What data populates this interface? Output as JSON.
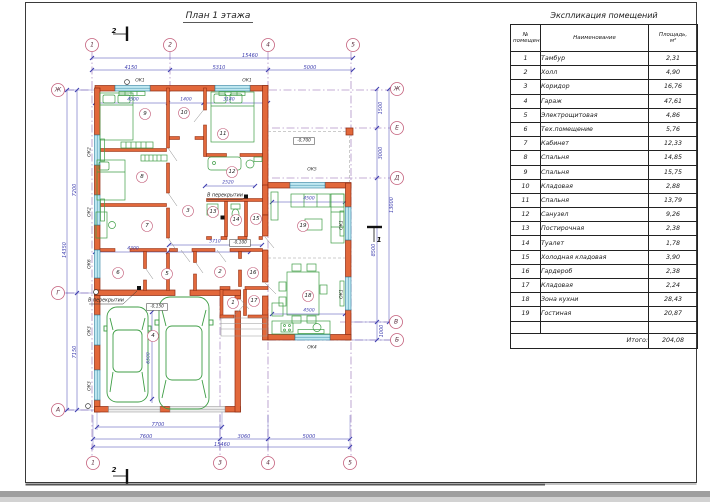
{
  "colors": {
    "wall_fill": "#e2683b",
    "wall_edge": "#8e2a10",
    "window_fill": "#bfe8f1",
    "window_edge": "#2e7f9e",
    "furniture": "#3f9e46",
    "dim": "#4040b0",
    "axis_line": "#8a5fae",
    "bubble": "#c4607c"
  },
  "plan": {
    "labels": [
      {
        "t": "План 1 этажа",
        "x": 218,
        "y": 16,
        "s": 9,
        "cls": "title",
        "n": "plan-title"
      },
      {
        "t": "1",
        "x": 92,
        "y": 45,
        "s": 6,
        "cls": "axis",
        "circle": true,
        "cr": 6.5,
        "n": "axis-top-1"
      },
      {
        "t": "2",
        "x": 170,
        "y": 45,
        "s": 6,
        "cls": "axis",
        "circle": true,
        "cr": 6.5,
        "n": "axis-top-2"
      },
      {
        "t": "4",
        "x": 268,
        "y": 45,
        "s": 6,
        "cls": "axis",
        "circle": true,
        "cr": 6.5,
        "n": "axis-top-4"
      },
      {
        "t": "5",
        "x": 353,
        "y": 45,
        "s": 6,
        "cls": "axis",
        "circle": true,
        "cr": 6.5,
        "n": "axis-top-5"
      },
      {
        "t": "1",
        "x": 93,
        "y": 463,
        "s": 6,
        "cls": "axis",
        "circle": true,
        "cr": 6.5,
        "n": "axis-bottom-1"
      },
      {
        "t": "3",
        "x": 220,
        "y": 463,
        "s": 6,
        "cls": "axis",
        "circle": true,
        "cr": 6.5,
        "n": "axis-bottom-3"
      },
      {
        "t": "4",
        "x": 268,
        "y": 463,
        "s": 6,
        "cls": "axis",
        "circle": true,
        "cr": 6.5,
        "n": "axis-bottom-4"
      },
      {
        "t": "5",
        "x": 350,
        "y": 463,
        "s": 6,
        "cls": "axis",
        "circle": true,
        "cr": 6.5,
        "n": "axis-bottom-5"
      },
      {
        "t": "Ж",
        "x": 58,
        "y": 90,
        "s": 6,
        "cls": "axis",
        "circle": true,
        "cr": 6.5,
        "n": "axis-left-zh"
      },
      {
        "t": "Г",
        "x": 58,
        "y": 293,
        "s": 6,
        "cls": "axis",
        "circle": true,
        "cr": 6.5,
        "n": "axis-left-g"
      },
      {
        "t": "А",
        "x": 58,
        "y": 410,
        "s": 6,
        "cls": "axis",
        "circle": true,
        "cr": 6.5,
        "n": "axis-left-a"
      },
      {
        "t": "Ж",
        "x": 397,
        "y": 89,
        "s": 6,
        "cls": "axis",
        "circle": true,
        "cr": 6.5,
        "n": "axis-right-zh"
      },
      {
        "t": "Е",
        "x": 397,
        "y": 128,
        "s": 6,
        "cls": "axis",
        "circle": true,
        "cr": 6.5,
        "n": "axis-right-e"
      },
      {
        "t": "Д",
        "x": 397,
        "y": 178,
        "s": 6,
        "cls": "axis",
        "circle": true,
        "cr": 6.5,
        "n": "axis-right-d"
      },
      {
        "t": "В",
        "x": 396,
        "y": 322,
        "s": 6,
        "cls": "axis",
        "circle": true,
        "cr": 6.5,
        "n": "axis-right-v"
      },
      {
        "t": "Б",
        "x": 397,
        "y": 340,
        "s": 6,
        "cls": "axis",
        "circle": true,
        "cr": 6.5,
        "n": "axis-right-b"
      },
      {
        "t": "15460",
        "x": 250,
        "y": 56,
        "s": 5,
        "cls": "dim",
        "n": "dim-label"
      },
      {
        "t": "4150",
        "x": 131,
        "y": 68,
        "s": 5,
        "cls": "dim",
        "n": "dim-label"
      },
      {
        "t": "5310",
        "x": 219,
        "y": 68,
        "s": 5,
        "cls": "dim",
        "n": "dim-label"
      },
      {
        "t": "5000",
        "x": 310,
        "y": 68,
        "s": 5,
        "cls": "dim",
        "n": "dim-label"
      },
      {
        "t": "7700",
        "x": 158,
        "y": 425,
        "s": 5,
        "cls": "dim",
        "n": "dim-label"
      },
      {
        "t": "7600",
        "x": 146,
        "y": 437,
        "s": 5,
        "cls": "dim",
        "n": "dim-label"
      },
      {
        "t": "3060",
        "x": 244,
        "y": 437,
        "s": 5,
        "cls": "dim",
        "n": "dim-label"
      },
      {
        "t": "5000",
        "x": 309,
        "y": 437,
        "s": 5,
        "cls": "dim",
        "n": "dim-label"
      },
      {
        "t": "15460",
        "x": 222,
        "y": 445,
        "s": 5,
        "cls": "dim",
        "n": "dim-label"
      },
      {
        "t": "7200",
        "x": 75,
        "y": 190,
        "s": 5,
        "r": -90,
        "cls": "dim",
        "n": "dim-label"
      },
      {
        "t": "7150",
        "x": 75,
        "y": 352,
        "s": 5,
        "r": -90,
        "cls": "dim",
        "n": "dim-label"
      },
      {
        "t": "14350",
        "x": 65,
        "y": 250,
        "s": 5,
        "r": -90,
        "cls": "dim",
        "n": "dim-label"
      },
      {
        "t": "1500",
        "x": 381,
        "y": 108,
        "s": 5,
        "r": -90,
        "cls": "dim",
        "n": "dim-label"
      },
      {
        "t": "3000",
        "x": 381,
        "y": 153,
        "s": 5,
        "r": -90,
        "cls": "dim",
        "n": "dim-label"
      },
      {
        "t": "8500",
        "x": 374,
        "y": 250,
        "s": 5,
        "r": -90,
        "cls": "dim",
        "n": "dim-label"
      },
      {
        "t": "1000",
        "x": 382,
        "y": 331,
        "s": 5,
        "r": -90,
        "cls": "dim",
        "n": "dim-label"
      },
      {
        "t": "13000",
        "x": 392,
        "y": 205,
        "s": 5,
        "r": -90,
        "cls": "dim",
        "n": "dim-label"
      },
      {
        "t": "4500",
        "x": 133,
        "y": 100,
        "s": 4.5,
        "cls": "dim",
        "n": "dim-label"
      },
      {
        "t": "1400",
        "x": 186,
        "y": 100,
        "s": 4.5,
        "cls": "dim",
        "n": "dim-label"
      },
      {
        "t": "3140",
        "x": 229,
        "y": 100,
        "s": 4.5,
        "cls": "dim",
        "n": "dim-label"
      },
      {
        "t": "4300",
        "x": 133,
        "y": 249,
        "s": 4.5,
        "cls": "dim",
        "n": "dim-label"
      },
      {
        "t": "5710",
        "x": 215,
        "y": 242,
        "s": 4.5,
        "cls": "dim",
        "n": "dim-label"
      },
      {
        "t": "2520",
        "x": 228,
        "y": 183,
        "s": 4.5,
        "cls": "dim",
        "n": "dim-label"
      },
      {
        "t": "4500",
        "x": 309,
        "y": 199,
        "s": 4.5,
        "cls": "dim",
        "n": "dim-label"
      },
      {
        "t": "4500",
        "x": 309,
        "y": 311,
        "s": 4.5,
        "cls": "dim",
        "n": "dim-label"
      },
      {
        "t": "6500",
        "x": 149,
        "y": 358,
        "s": 4.5,
        "r": -90,
        "cls": "dim",
        "n": "dim-label"
      },
      {
        "t": "ОК1",
        "x": 140,
        "y": 81,
        "s": 4.5,
        "cls": "tag",
        "n": "window-tag"
      },
      {
        "t": "ОК1",
        "x": 247,
        "y": 81,
        "s": 4.5,
        "cls": "tag",
        "n": "window-tag"
      },
      {
        "t": "ОК2",
        "x": 90,
        "y": 152,
        "s": 4.5,
        "r": -90,
        "cls": "tag",
        "n": "window-tag"
      },
      {
        "t": "ОК2",
        "x": 90,
        "y": 212,
        "s": 4.5,
        "r": -90,
        "cls": "tag",
        "n": "window-tag"
      },
      {
        "t": "ОК6",
        "x": 90,
        "y": 264,
        "s": 4.5,
        "r": -90,
        "cls": "tag",
        "n": "window-tag"
      },
      {
        "t": "ОК3",
        "x": 90,
        "y": 331,
        "s": 4.5,
        "r": -90,
        "cls": "tag",
        "n": "window-tag"
      },
      {
        "t": "ОК3",
        "x": 90,
        "y": 386,
        "s": 4.5,
        "r": -90,
        "cls": "tag",
        "n": "window-tag"
      },
      {
        "t": "ОК5",
        "x": 312,
        "y": 170,
        "s": 4.5,
        "cls": "tag",
        "n": "window-tag"
      },
      {
        "t": "ОК4",
        "x": 312,
        "y": 348,
        "s": 4.5,
        "cls": "tag",
        "n": "window-tag"
      },
      {
        "t": "ОК1",
        "x": 342,
        "y": 225,
        "s": 4.5,
        "r": -90,
        "cls": "tag",
        "n": "window-tag"
      },
      {
        "t": "ОК1",
        "x": 342,
        "y": 294,
        "s": 4.5,
        "r": -90,
        "cls": "tag",
        "n": "window-tag"
      },
      {
        "t": "1",
        "x": 233,
        "y": 303,
        "s": 5.5,
        "circle": true,
        "cr": 5.5,
        "cls": "room",
        "n": "room-number-1"
      },
      {
        "t": "2",
        "x": 220,
        "y": 272,
        "s": 5.5,
        "circle": true,
        "cr": 5.5,
        "cls": "room",
        "n": "room-number-2"
      },
      {
        "t": "3",
        "x": 188,
        "y": 211,
        "s": 5.5,
        "circle": true,
        "cr": 5.5,
        "cls": "room",
        "n": "room-number-3"
      },
      {
        "t": "4",
        "x": 153,
        "y": 336,
        "s": 5.5,
        "circle": true,
        "cr": 5.5,
        "cls": "room",
        "n": "room-number-4"
      },
      {
        "t": "5",
        "x": 167,
        "y": 274,
        "s": 5.5,
        "circle": true,
        "cr": 5.5,
        "cls": "room",
        "n": "room-number-5"
      },
      {
        "t": "6",
        "x": 118,
        "y": 273,
        "s": 5.5,
        "circle": true,
        "cr": 5.5,
        "cls": "room",
        "n": "room-number-6"
      },
      {
        "t": "7",
        "x": 147,
        "y": 226,
        "s": 5.5,
        "circle": true,
        "cr": 5.5,
        "cls": "room",
        "n": "room-number-7"
      },
      {
        "t": "8",
        "x": 142,
        "y": 177,
        "s": 5.5,
        "circle": true,
        "cr": 5.5,
        "cls": "room",
        "n": "room-number-8"
      },
      {
        "t": "9",
        "x": 145,
        "y": 114,
        "s": 5.5,
        "circle": true,
        "cr": 5.5,
        "cls": "room",
        "n": "room-number-9"
      },
      {
        "t": "10",
        "x": 184,
        "y": 113,
        "s": 5.5,
        "circle": true,
        "cr": 5.5,
        "cls": "room",
        "n": "room-number-10"
      },
      {
        "t": "11",
        "x": 223,
        "y": 134,
        "s": 5.5,
        "circle": true,
        "cr": 5.5,
        "cls": "room",
        "n": "room-number-11"
      },
      {
        "t": "12",
        "x": 232,
        "y": 172,
        "s": 5.5,
        "circle": true,
        "cr": 5.5,
        "cls": "room",
        "n": "room-number-12"
      },
      {
        "t": "13",
        "x": 213,
        "y": 212,
        "s": 5.5,
        "circle": true,
        "cr": 5.5,
        "cls": "room",
        "n": "room-number-13"
      },
      {
        "t": "14",
        "x": 236,
        "y": 220,
        "s": 5.5,
        "circle": true,
        "cr": 5.5,
        "cls": "room",
        "n": "room-number-14"
      },
      {
        "t": "15",
        "x": 256,
        "y": 219,
        "s": 5.5,
        "circle": true,
        "cr": 5.5,
        "cls": "room",
        "n": "room-number-15"
      },
      {
        "t": "16",
        "x": 253,
        "y": 273,
        "s": 5.5,
        "circle": true,
        "cr": 5.5,
        "cls": "room",
        "n": "room-number-16"
      },
      {
        "t": "17",
        "x": 254,
        "y": 301,
        "s": 5.5,
        "circle": true,
        "cr": 5.5,
        "cls": "room",
        "n": "room-number-17"
      },
      {
        "t": "18",
        "x": 308,
        "y": 296,
        "s": 5.5,
        "circle": true,
        "cr": 5.5,
        "cls": "room",
        "n": "room-number-18"
      },
      {
        "t": "19",
        "x": 303,
        "y": 226,
        "s": 5.5,
        "circle": true,
        "cr": 5.5,
        "cls": "room",
        "n": "room-number-19"
      },
      {
        "t": "-0,100",
        "x": 240,
        "y": 243,
        "s": 4.3,
        "box": true,
        "cls": "elev",
        "n": "elevation-mark"
      },
      {
        "t": "-0,150",
        "x": 157,
        "y": 307,
        "s": 4.3,
        "box": true,
        "cls": "elev",
        "n": "elevation-mark"
      },
      {
        "t": "-0,700",
        "x": 304,
        "y": 141,
        "s": 4.3,
        "box": true,
        "cls": "elev",
        "n": "elevation-mark"
      },
      {
        "t": "В перекрытии",
        "x": 225,
        "y": 196,
        "s": 4.8,
        "cls": "ann",
        "n": "slab-note"
      },
      {
        "t": "В перекрытии",
        "x": 106,
        "y": 301,
        "s": 4.8,
        "cls": "ann",
        "n": "slab-note"
      },
      {
        "t": "2",
        "x": 114,
        "y": 31,
        "s": 7,
        "cls": "sect",
        "n": "section-mark-label"
      },
      {
        "t": "2",
        "x": 114,
        "y": 470,
        "s": 7,
        "cls": "sect",
        "n": "section-mark-label"
      },
      {
        "t": "1",
        "x": 379,
        "y": 240,
        "s": 7,
        "cls": "sect",
        "n": "section-mark-label"
      }
    ]
  },
  "table": {
    "title": "Экспликация помещений",
    "headers": {
      "num": "№ помещения",
      "name": "Наименование",
      "area": "Площадь, м²"
    },
    "rows": [
      {
        "num": "1",
        "name": "Тамбур",
        "area": "2,31"
      },
      {
        "num": "2",
        "name": "Холл",
        "area": "4,90"
      },
      {
        "num": "3",
        "name": "Коридор",
        "area": "16,76"
      },
      {
        "num": "4",
        "name": "Гараж",
        "area": "47,61"
      },
      {
        "num": "5",
        "name": "Электрощитовая",
        "area": "4,86"
      },
      {
        "num": "6",
        "name": "Тех.помещение",
        "area": "5,76"
      },
      {
        "num": "7",
        "name": "Кабинет",
        "area": "12,33"
      },
      {
        "num": "8",
        "name": "Спальня",
        "area": "14,85"
      },
      {
        "num": "9",
        "name": "Спальня",
        "area": "15,75"
      },
      {
        "num": "10",
        "name": "Кладовая",
        "area": "2,88"
      },
      {
        "num": "11",
        "name": "Спальня",
        "area": "13,79"
      },
      {
        "num": "12",
        "name": "Санузел",
        "area": "9,26"
      },
      {
        "num": "13",
        "name": "Постирочная",
        "area": "2,38"
      },
      {
        "num": "14",
        "name": "Туалет",
        "area": "1,78"
      },
      {
        "num": "15",
        "name": "Холодная кладовая",
        "area": "3,90"
      },
      {
        "num": "16",
        "name": "Гардероб",
        "area": "2,38"
      },
      {
        "num": "17",
        "name": "Кладовая",
        "area": "2,24"
      },
      {
        "num": "18",
        "name": "Зона кухни",
        "area": "28,43"
      },
      {
        "num": "19",
        "name": "Гостиная",
        "area": "20,87"
      }
    ],
    "total_label": "Итого:",
    "total_value": "204,08"
  }
}
